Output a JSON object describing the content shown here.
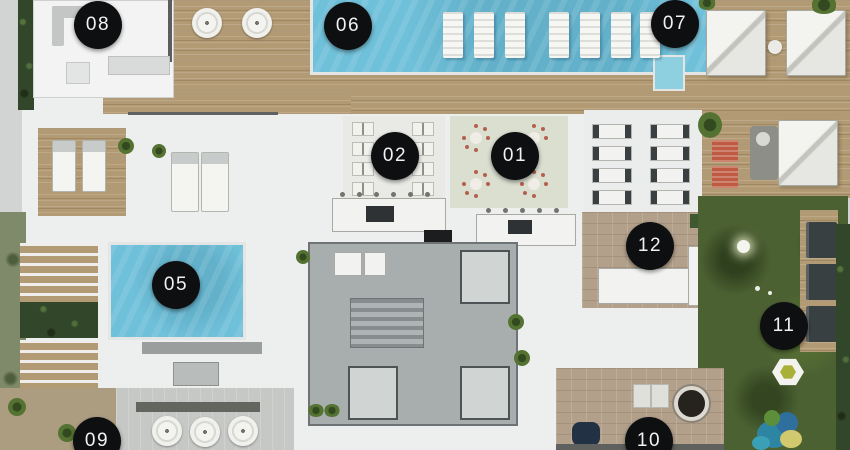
{
  "plan": {
    "markers": [
      {
        "label": "08",
        "x": 98,
        "y": 25
      },
      {
        "label": "06",
        "x": 348,
        "y": 26
      },
      {
        "label": "07",
        "x": 675,
        "y": 24
      },
      {
        "label": "02",
        "x": 395,
        "y": 156
      },
      {
        "label": "01",
        "x": 515,
        "y": 156
      },
      {
        "label": "12",
        "x": 650,
        "y": 246
      },
      {
        "label": "05",
        "x": 176,
        "y": 285
      },
      {
        "label": "11",
        "x": 784,
        "y": 326
      },
      {
        "label": "09",
        "x": 97,
        "y": 441
      },
      {
        "label": "10",
        "x": 649,
        "y": 441
      }
    ],
    "palette": {
      "concrete": "#d2d4d4",
      "slab_white": "#edefee",
      "wood_deck": "#b29a74",
      "pool_blue": "#6fc0d9",
      "pool_step": "#8fd0e0",
      "lawn_green": "#4c6132",
      "hedge_green": "#32472a",
      "stone_paver": "#b2a08b",
      "core_gray": "#a8adae",
      "marker_bg": "#0e0f10",
      "marker_text": "#f2f2f2",
      "accent_red": "#b55f4e"
    }
  }
}
